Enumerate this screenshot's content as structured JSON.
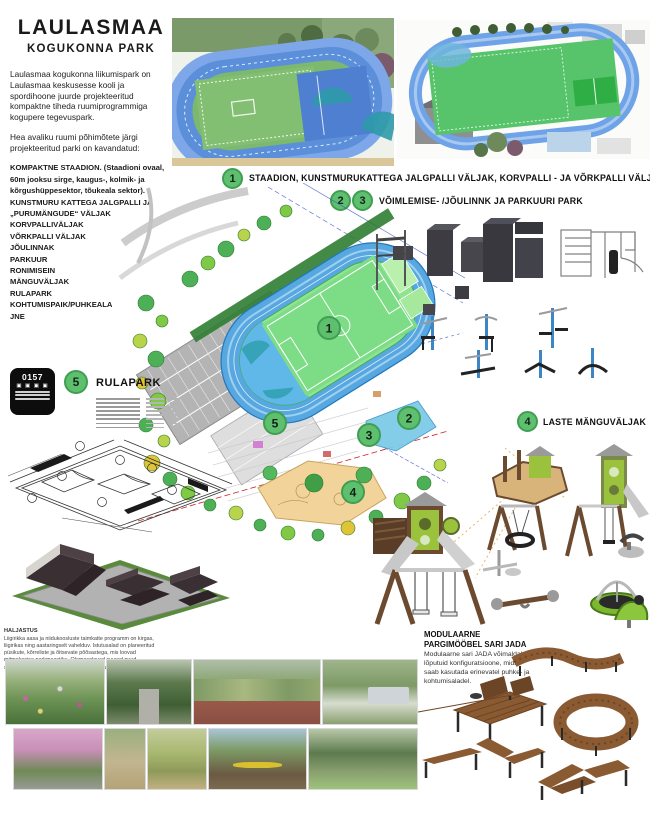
{
  "poster": {
    "title": "LAULASMAA",
    "subtitle": "KOGUKONNA PARK",
    "intro_p1": "Laulasmaa kogukonna liikumispark on Laulasmaa keskusesse kooli ja spordihoone juurde projekteeritud kompaktne tiheda ruumiprogrammiga kogupere tegevuspark.",
    "intro_p2": "Hea avaliku ruumi põhimõtete järgi projekteeritud parki on kavandatud:",
    "features": [
      "KOMPAKTNE STAADION. (Staadioni ovaal, 60m jooksu sirge, kaugus-, kolmik- ja kõrgushüppesektor, tõukeala sektor).",
      "KUNSTMURU KATTEGA JALGPALLI JA „PURUMÄNGUDE“ VÄLJAK",
      "KORVPALLIVÄLJAK",
      "VÕRKPALLI VÄLJAK",
      "JÕULINNAK",
      "PARKUUR",
      "RONIMISEIN",
      "MÄNGUVÄLJAK",
      "RULAPARK",
      "KOHTUMISPAIK/PUHKEALA",
      "JNE"
    ]
  },
  "sections": {
    "s1": {
      "num": "1",
      "label": "STAADION, KUNSTMURUKATTEGA JALGPALLI VÄLJAK, KORVPALLI - JA VÕRKPALLI VÄLJAK"
    },
    "s23": {
      "num_a": "2",
      "num_b": "3",
      "label": "VÕIMLEMISE- /JÕULINNK JA PARKUURI PARK"
    },
    "s4": {
      "num": "4",
      "label": "LASTE MÄNGUVÄLJAK"
    },
    "s5": {
      "num": "5",
      "label": "RULAPARK"
    }
  },
  "map_markers": {
    "m1": "1",
    "m2": "2",
    "m3": "3",
    "m4": "4",
    "m5": "5"
  },
  "stamp": {
    "code": "0157",
    "glyphs": "▣ ▣ ▣ ▣"
  },
  "notes": {
    "title": "HALJASTUS",
    "body": "Liigirikka aasa ja niidukoosluste taimkatte programm on kirgas, liigirikas ning aastaringselt vahelduv. Istutusalad on planeeritud püsikute, kõrreliste ja õitsevate põõsastega, mis loovad mitmekesise parkmaastiku. Olemasolevad suured puud säilitatakse ning neid täiendatakse uushaljastusega."
  },
  "furniture": {
    "heading_line1": "MODULAARNE",
    "heading_line2": "PARGIMÖÖBEL SARI JADA",
    "body": "Modulaarne sari JADA võimaldab lõputuid konfiguratsioone, mida saab kasutada erinevatel puhke- ja kohtumisaladel."
  },
  "colors": {
    "marker_green": "#5ec06e",
    "track_blue": "#57a8e0",
    "field_green": "#8fe391",
    "sand": "#f2d49b",
    "wood": "#8a5a33"
  }
}
